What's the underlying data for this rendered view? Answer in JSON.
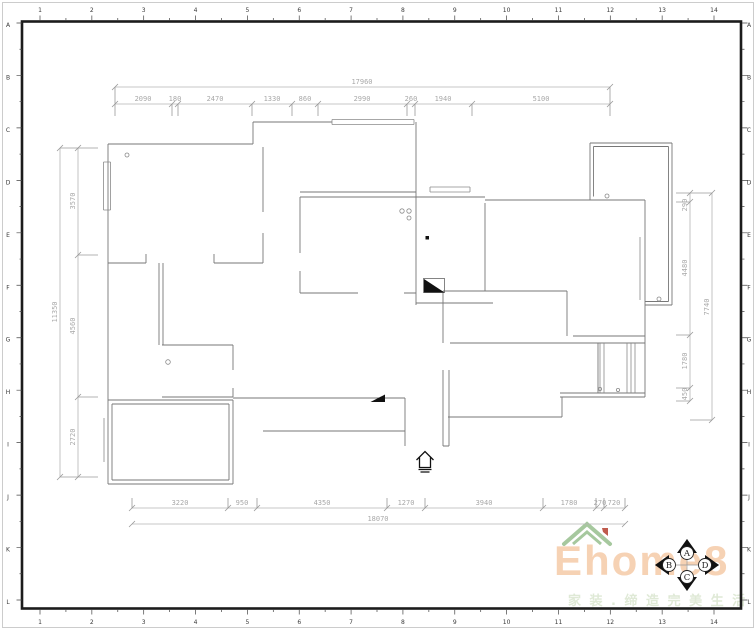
{
  "frame": {
    "columns": [
      "1",
      "2",
      "3",
      "4",
      "5",
      "6",
      "7",
      "8",
      "9",
      "10",
      "11",
      "12",
      "13",
      "14"
    ],
    "rows": [
      "A",
      "B",
      "C",
      "D",
      "E",
      "F",
      "G",
      "H",
      "I",
      "J",
      "K",
      "L"
    ]
  },
  "dimensions": {
    "top": {
      "total": "17960",
      "segments": [
        "2090",
        "180",
        "2470",
        "1330",
        "860",
        "2990",
        "260",
        "1940",
        "5100"
      ]
    },
    "bottom": {
      "total": "18070",
      "segments": [
        "3220",
        "950",
        "4350",
        "1270",
        "3940",
        "1780",
        "270",
        "720"
      ]
    },
    "left": {
      "total": "11350",
      "segments": [
        "3570",
        "4560",
        "2720"
      ]
    },
    "right": {
      "total": "7740",
      "segments": [
        "290",
        "4480",
        "1780",
        "450"
      ]
    }
  },
  "compass": {
    "north": "A",
    "west": "B",
    "south": "C",
    "east": "D"
  },
  "logo": {
    "brand": "Ehome8",
    "tagline": "家 装 . 缔 造 完 美 生 活"
  },
  "colors": {
    "frame": "#1c1c1c",
    "walls": "#777777",
    "dims": "#a8a8a8",
    "brand": "#f5c7a2",
    "roof": "#a6c89e",
    "chimney": "#bf5b4d",
    "tagline": "#dfe9d6"
  }
}
